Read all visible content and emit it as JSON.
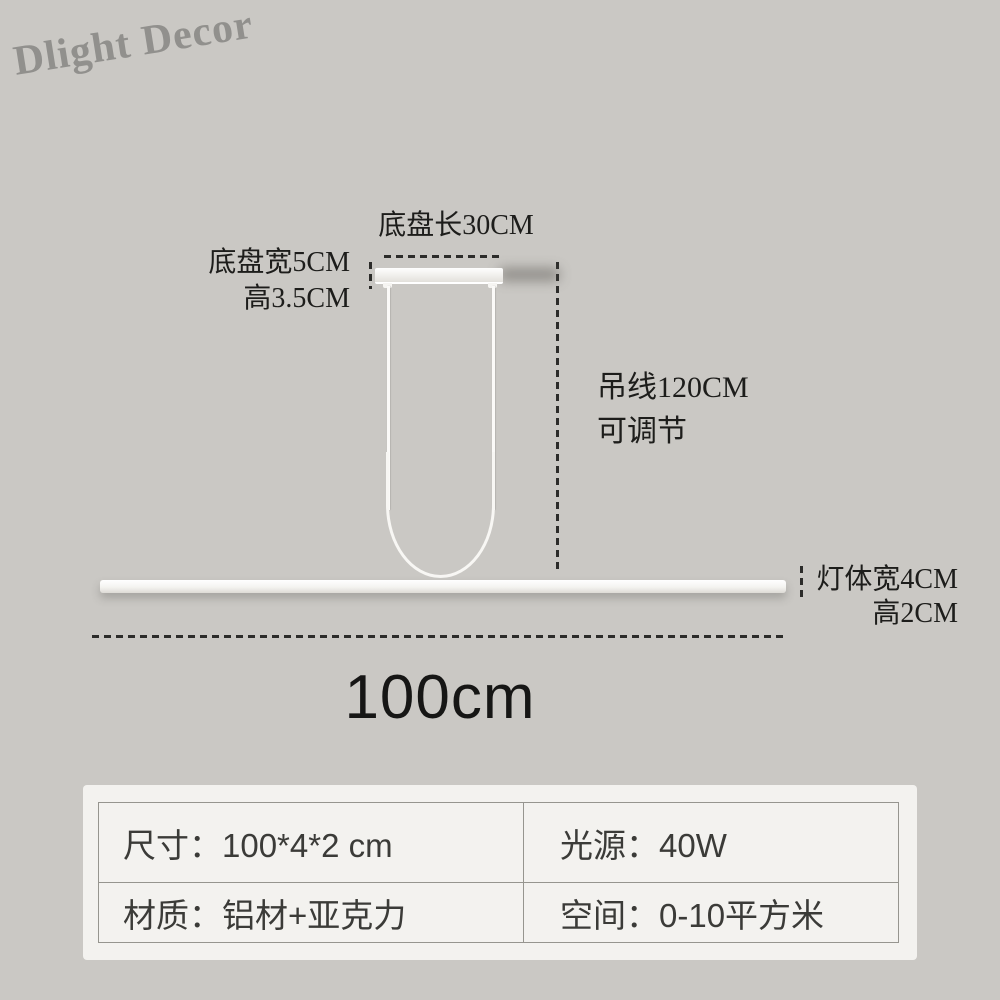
{
  "watermark": {
    "text": "Dlight Decor"
  },
  "diagram": {
    "canopy_length": "底盘长30CM",
    "canopy_width": "底盘宽5CM",
    "canopy_height": "高3.5CM",
    "wire_length": "吊线120CM",
    "wire_adjustable": "可调节",
    "body_width": "灯体宽4CM",
    "body_height": "高2CM",
    "total_length": "100cm"
  },
  "spec_table": {
    "cells": [
      {
        "label": "尺寸",
        "value": "100*4*2 cm",
        "text": "尺寸：100*4*2 cm"
      },
      {
        "label": "光源",
        "value": "40W",
        "text": "光源：40W"
      },
      {
        "label": "材质",
        "value": "铝材+亚克力",
        "text": "材质：铝材+亚克力"
      },
      {
        "label": "空间",
        "value": "0-10平方米",
        "text": "空间：0-10平方米"
      }
    ]
  },
  "colors": {
    "background": "#cac8c4",
    "card": "#f3f2ef",
    "table_border": "#96958f",
    "table_text": "#3b3b38",
    "annotation_text": "#1d1d1b",
    "lamp_white": "#f8f7f4",
    "watermark_gray": "#686865"
  }
}
